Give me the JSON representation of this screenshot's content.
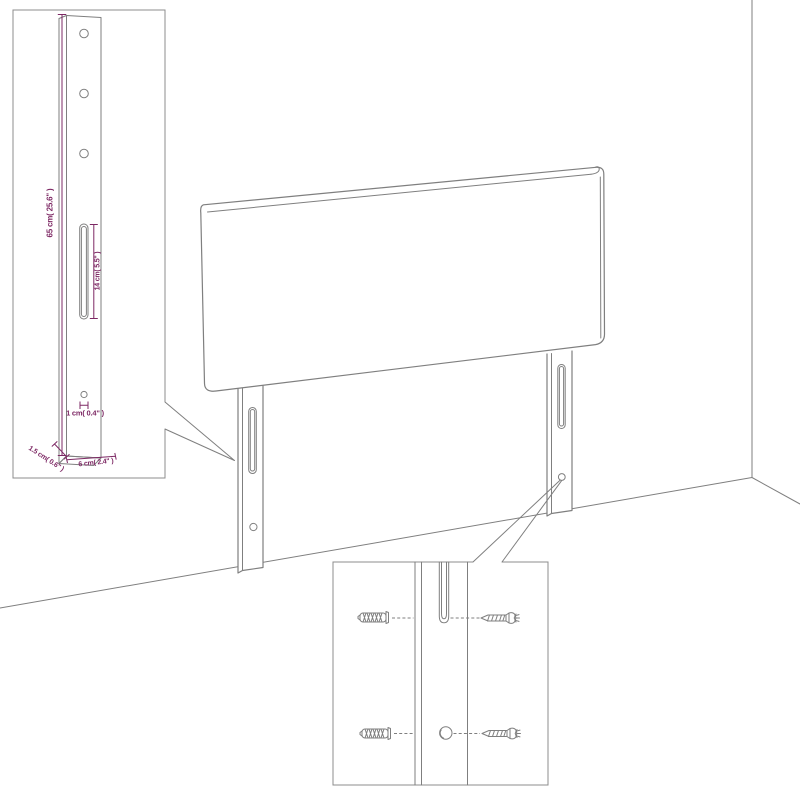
{
  "colors": {
    "line": "#7f7f7f",
    "box_border": "#8c8c8c",
    "dimension": "#7d2864",
    "background": "#ffffff"
  },
  "post_detail_inset": {
    "labels": {
      "height": "65 cm( 25.6\" )",
      "slot_height": "14 cm( 5.5\" )",
      "hole_offset": "1 cm( 0.4\" )",
      "leg_depth": "1.5 cm( 0.6\" )",
      "leg_width": "6 cm( 2.4\" )"
    },
    "features": [
      "three-holes",
      "mounting-slot",
      "small-hole"
    ]
  },
  "hardware_detail_inset": {
    "icons": [
      {
        "name": "wall-plug-icon",
        "count": 2
      },
      {
        "name": "screw-icon",
        "count": 2
      }
    ]
  }
}
